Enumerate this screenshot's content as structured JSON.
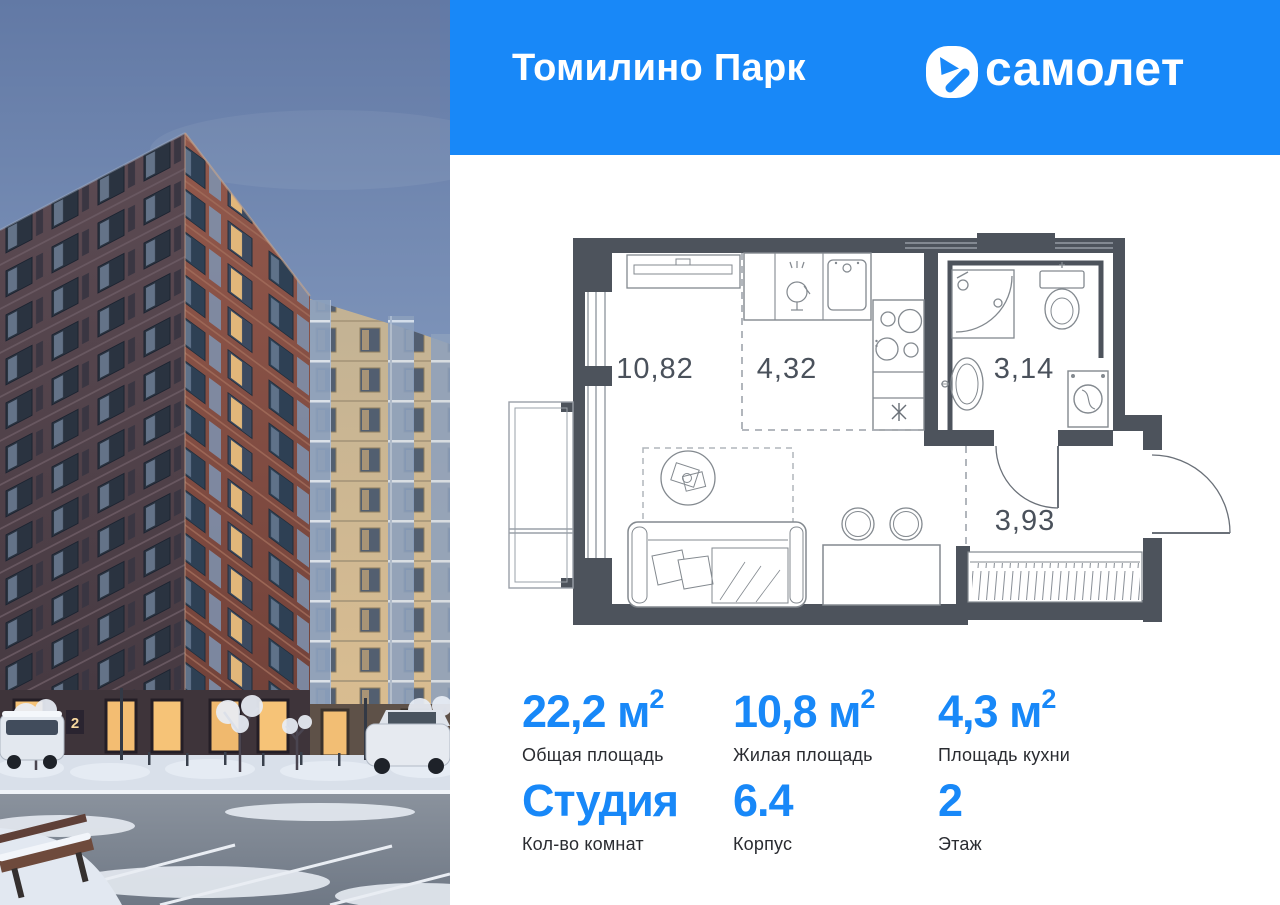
{
  "colors": {
    "brand_blue": "#1888F8",
    "wall_gray": "#4D535C",
    "photo_sky": "#6F84AB",
    "photo_brick": "#8A5146"
  },
  "header": {
    "title": "Томилино Парк",
    "logo_text": "самолет"
  },
  "floorplan": {
    "rooms": [
      {
        "id": "living",
        "area": "10,82"
      },
      {
        "id": "kitchen",
        "area": "4,32"
      },
      {
        "id": "bathroom",
        "area": "3,14"
      },
      {
        "id": "hallway",
        "area": "3,93"
      }
    ]
  },
  "stats": {
    "items": [
      {
        "value": "22,2",
        "unit": " м",
        "sup": "2",
        "label": "Общая площадь"
      },
      {
        "value": "10,8",
        "unit": " м",
        "sup": "2",
        "label": "Жилая площадь"
      },
      {
        "value": "4,3",
        "unit": " м",
        "sup": "2",
        "label": "Площадь кухни"
      },
      {
        "value": "Студия",
        "unit": "",
        "sup": "",
        "label": "Кол-во комнат"
      },
      {
        "value": "6.4",
        "unit": "",
        "sup": "",
        "label": "Корпус"
      },
      {
        "value": "2",
        "unit": "",
        "sup": "",
        "label": "Этаж"
      }
    ]
  },
  "photo": {
    "entrance_sign": "2"
  }
}
